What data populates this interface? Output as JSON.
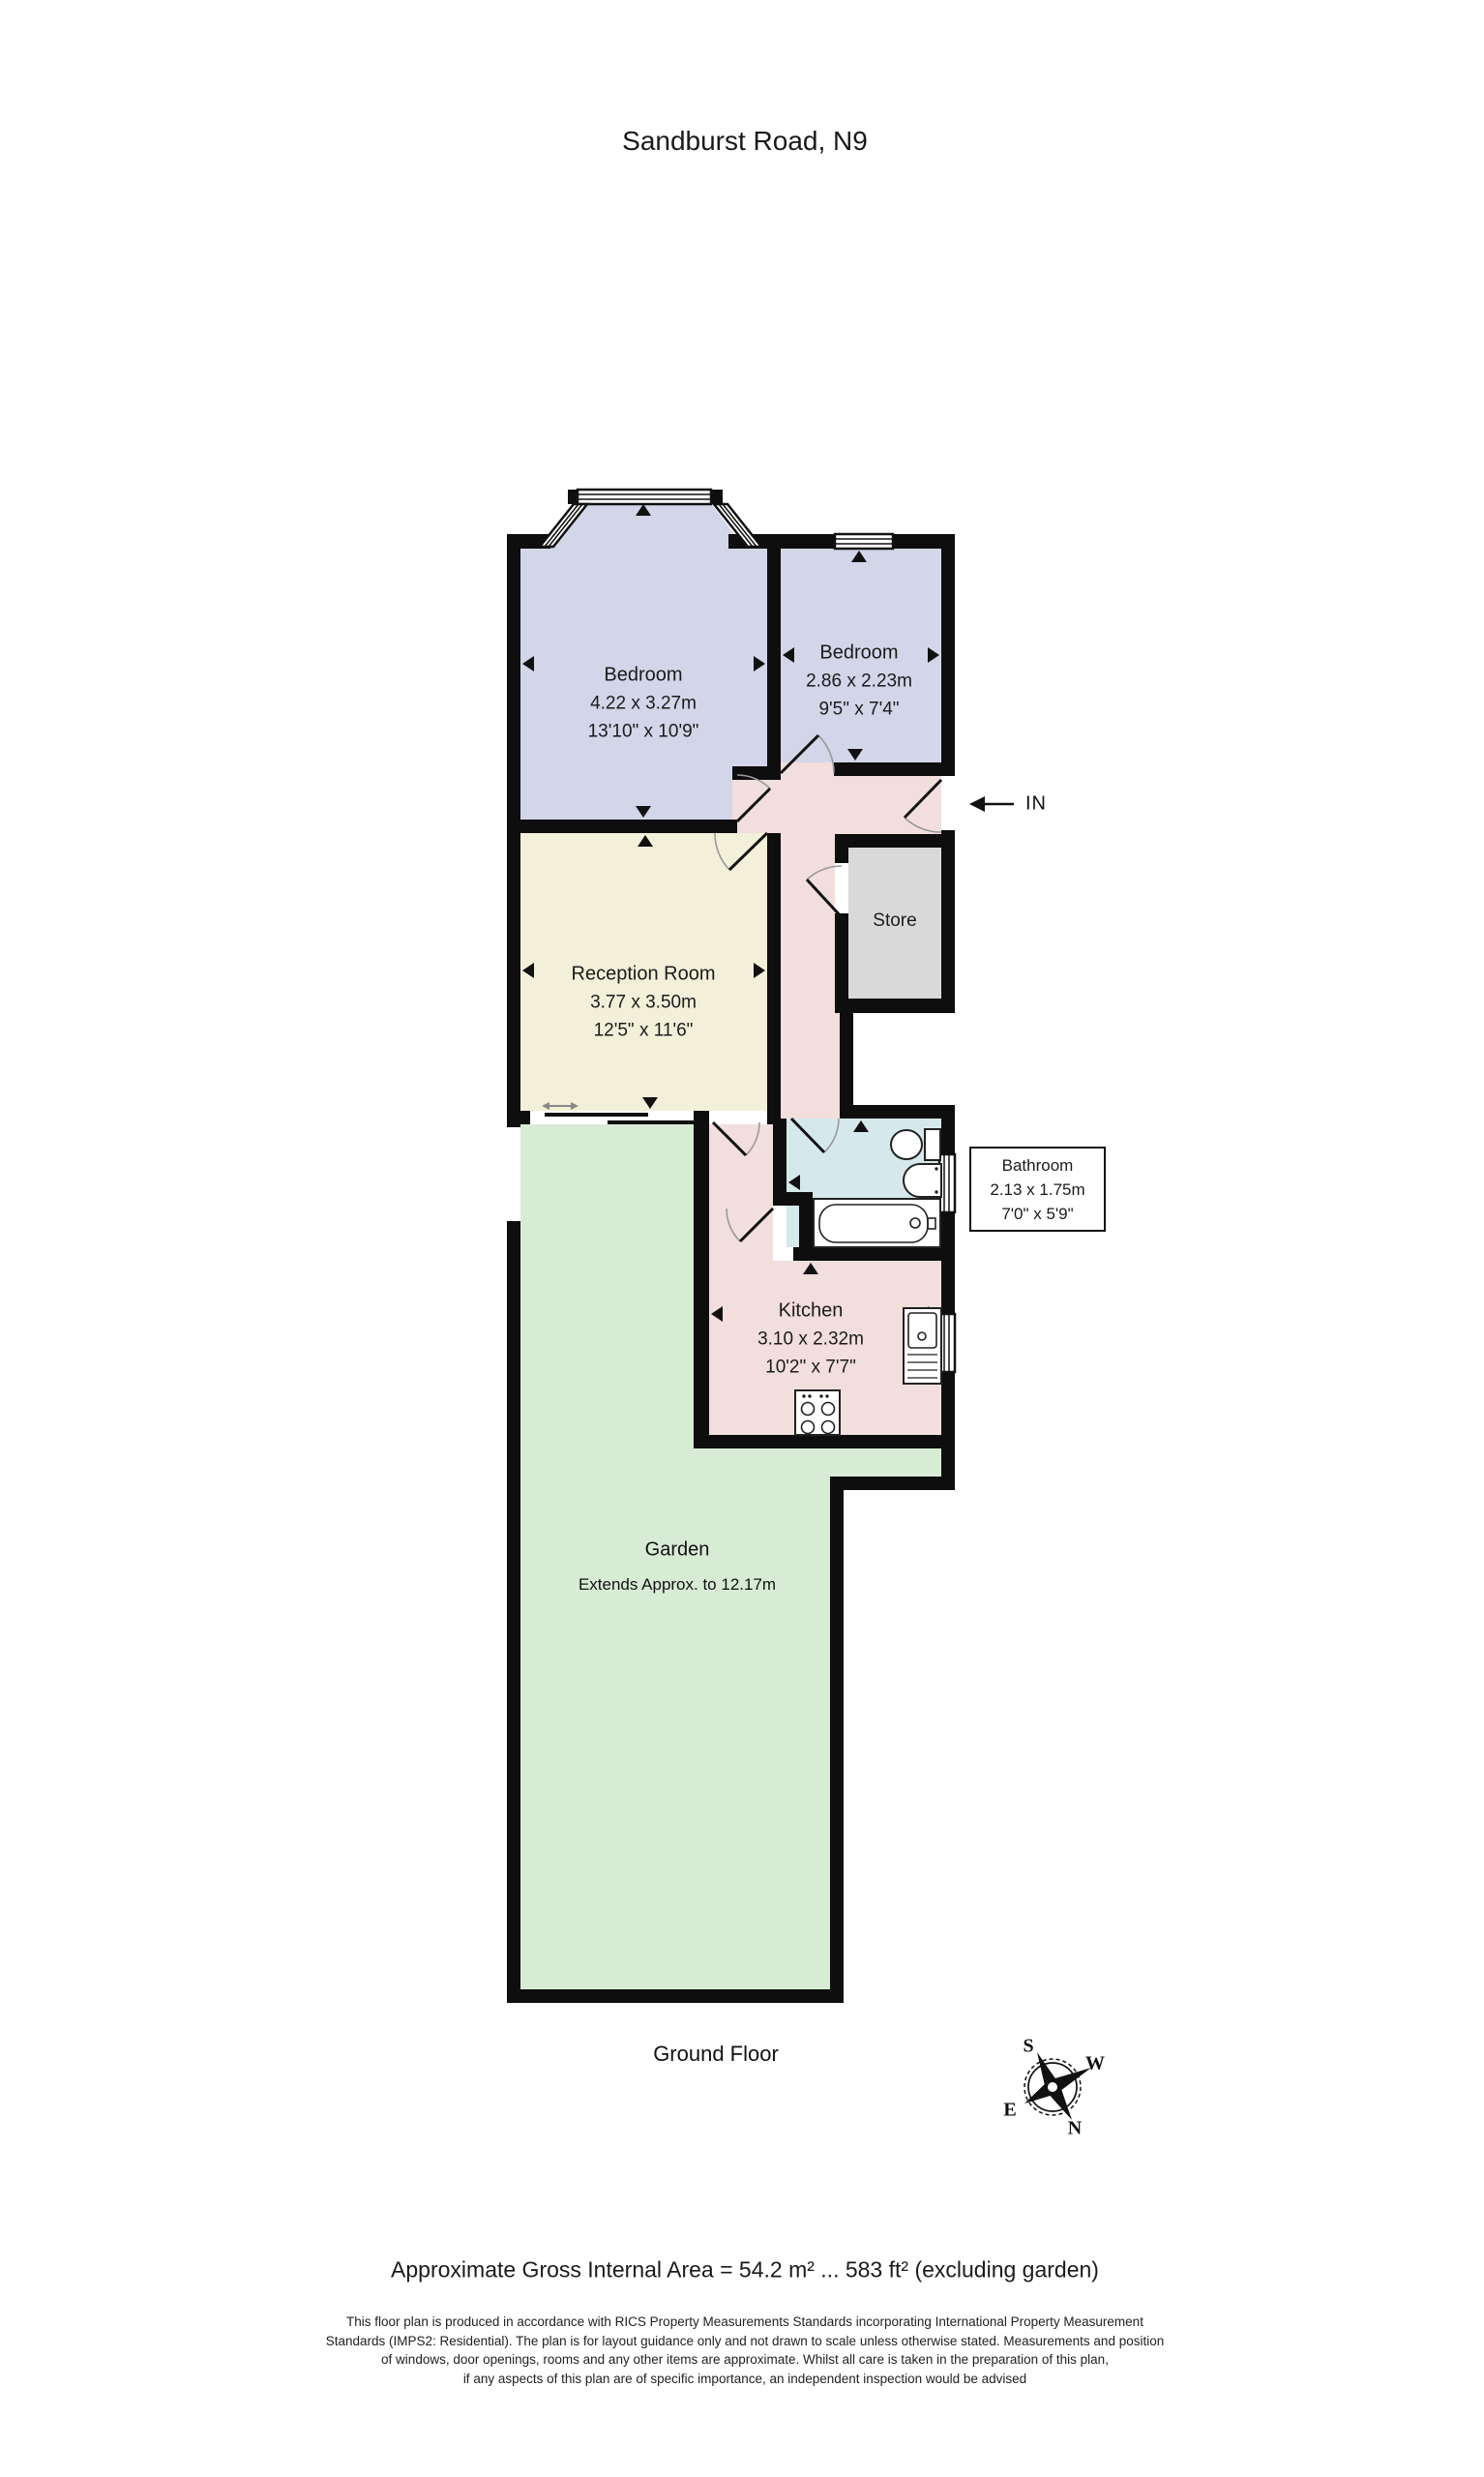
{
  "title": "Sandburst Road, N9",
  "floor_label": "Ground Floor",
  "entrance_label": "IN",
  "area_note": "Approximate Gross Internal Area = 54.2 m² ... 583 ft² (excluding garden)",
  "rooms": {
    "bedroom1": {
      "name": "Bedroom",
      "dim_m": "4.22 x 3.27m",
      "dim_ft": "13'10\" x 10'9\""
    },
    "bedroom2": {
      "name": "Bedroom",
      "dim_m": "2.86 x 2.23m",
      "dim_ft": "9'5\" x 7'4\""
    },
    "reception": {
      "name": "Reception Room",
      "dim_m": "3.77 x 3.50m",
      "dim_ft": "12'5\" x 11'6\""
    },
    "store": {
      "name": "Store"
    },
    "bathroom": {
      "name": "Bathroom",
      "dim_m": "2.13 x 1.75m",
      "dim_ft": "7'0\" x 5'9\""
    },
    "kitchen": {
      "name": "Kitchen",
      "dim_m": "3.10 x 2.32m",
      "dim_ft": "10'2\" x 7'7\""
    },
    "garden": {
      "name": "Garden",
      "note": "Extends Approx. to 12.17m"
    }
  },
  "compass": {
    "n": "N",
    "e": "E",
    "s": "S",
    "w": "W"
  },
  "disclaimer": {
    "lines": [
      "This floor plan is produced in accordance with RICS Property Measurements Standards incorporating International Property Measurement",
      "Standards (IMPS2: Residential). The plan is for layout guidance only and not drawn to scale unless otherwise stated. Measurements and position",
      "of windows, door openings, rooms and any other items are approximate. Whilst all care is taken in the preparation of this plan,",
      "if any aspects of this plan are of specific importance, an independent inspection would be advised"
    ]
  },
  "colors": {
    "bedroom": "#d3d5e9",
    "hall": "#f2dedd",
    "reception": "#f2f0d9",
    "store": "#d9d9d9",
    "bathroom": "#d5e8ea",
    "garden": "#d8ecd5",
    "wall": "#0e0e0e"
  }
}
